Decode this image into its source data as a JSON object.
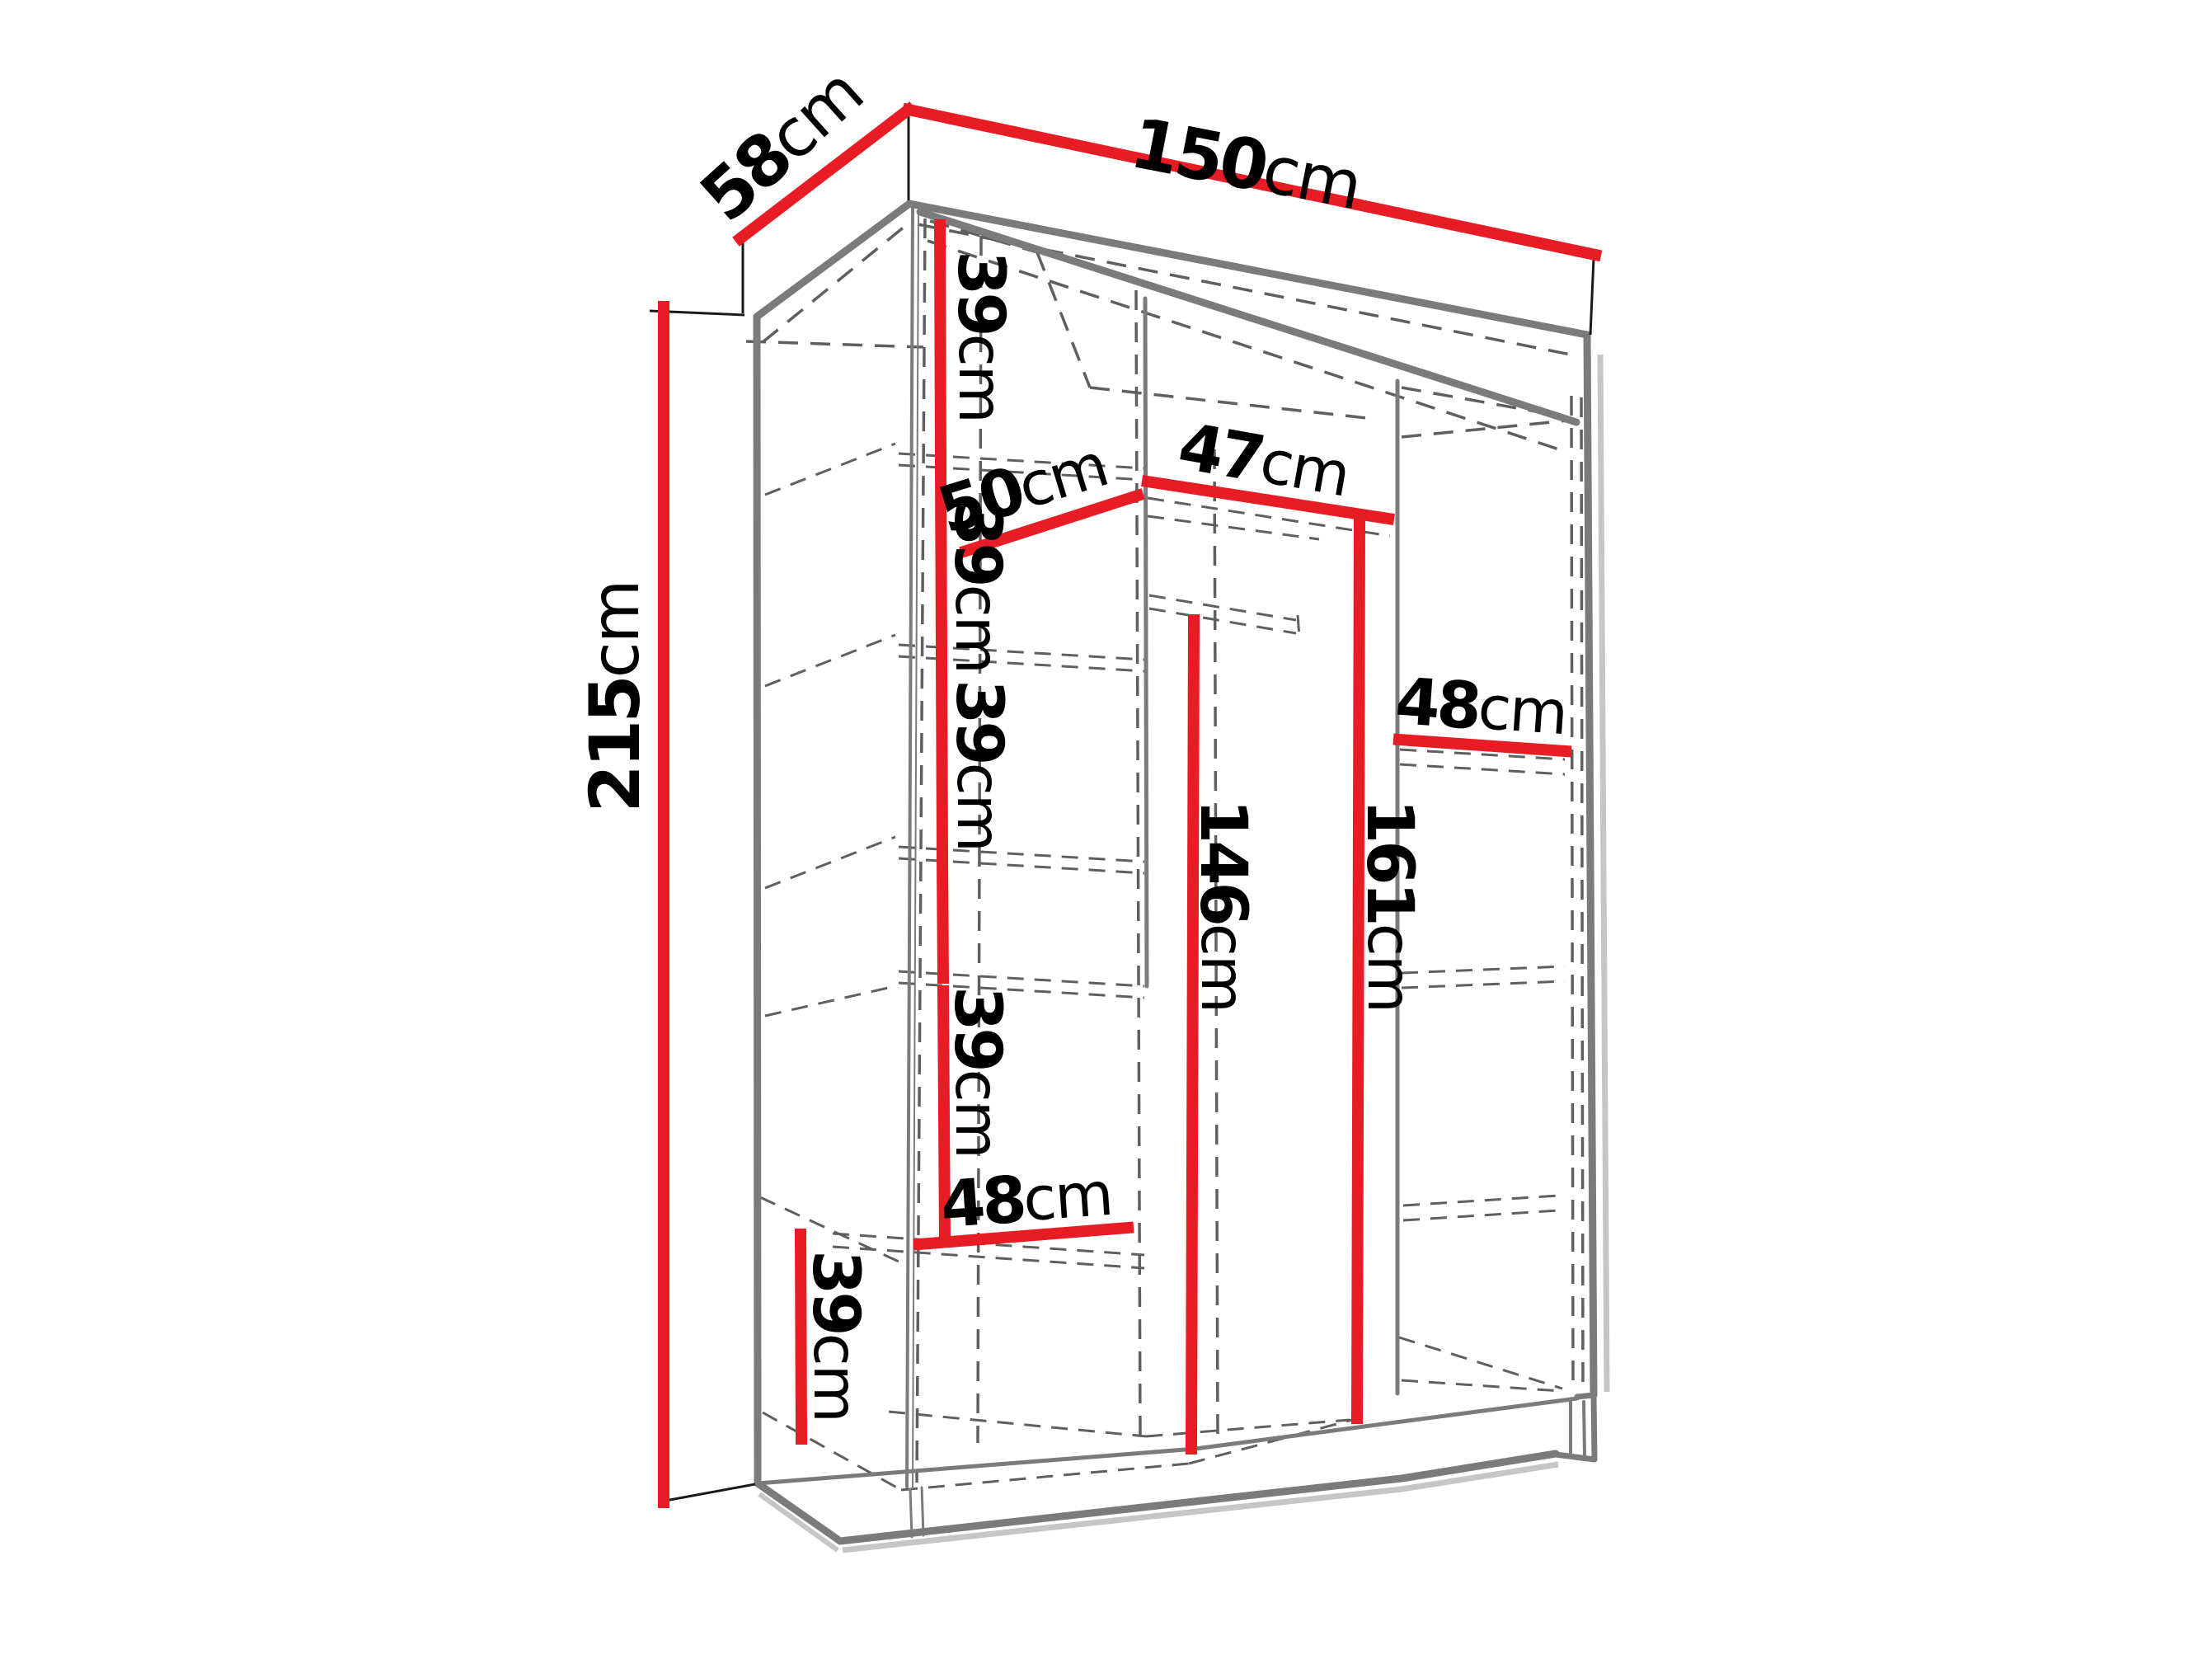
{
  "diagram": "wardrobe-dimension-drawing",
  "colors": {
    "dimension_line": "#e81c24",
    "outline": "#7b7b7b",
    "hidden_line": "#5f5f5f",
    "text": "#000000",
    "background": "#ffffff"
  },
  "dims": {
    "width": {
      "value": "150",
      "unit": "cm"
    },
    "depth": {
      "value": "58",
      "unit": "cm"
    },
    "height": {
      "value": "215",
      "unit": "cm"
    },
    "shelf1": {
      "value": "39",
      "unit": "cm"
    },
    "shelf2": {
      "value": "39",
      "unit": "cm"
    },
    "shelf3": {
      "value": "39",
      "unit": "cm"
    },
    "shelf4": {
      "value": "39",
      "unit": "cm"
    },
    "bottom_shelf": {
      "value": "39",
      "unit": "cm"
    },
    "left_width": {
      "value": "50",
      "unit": "cm"
    },
    "middle_width": {
      "value": "47",
      "unit": "cm"
    },
    "right_width": {
      "value": "48",
      "unit": "cm"
    },
    "bottom_width": {
      "value": "48",
      "unit": "cm"
    },
    "hang_middle": {
      "value": "146",
      "unit": "cm"
    },
    "hang_right": {
      "value": "161",
      "unit": "cm"
    }
  }
}
